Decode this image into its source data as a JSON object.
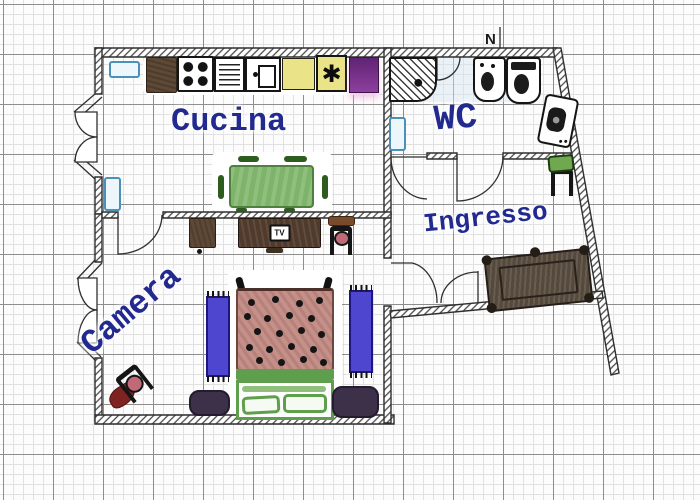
{
  "floorplan": {
    "rooms": {
      "cucina": {
        "label": "Cucina"
      },
      "wc": {
        "label": "WC"
      },
      "ingresso": {
        "label": "Ingresso"
      },
      "camera": {
        "label": "Camera"
      }
    },
    "north_marker": {
      "label": "N"
    },
    "icons": {
      "tv": "TV",
      "hob_star": "✱"
    },
    "colors": {
      "label_ink": "#232a8f",
      "wall_line": "#2f2f2f",
      "table_green": "#7eb469",
      "bed_blanket": "#c49089",
      "bed_green": "#5f9e4c",
      "rug_blue": "#4f46cf",
      "rug_purple": "#3c3148",
      "cabinet_purple": "#8e3f9e",
      "counter_yellow": "#eae387",
      "wood_brown": "#5e4936",
      "bench_brown": "#55493c",
      "radiator_blue": "#4a90b8",
      "seat_pink": "#c06a78",
      "stool_green": "#6fa84f",
      "rug_red": "#7e2222"
    }
  }
}
